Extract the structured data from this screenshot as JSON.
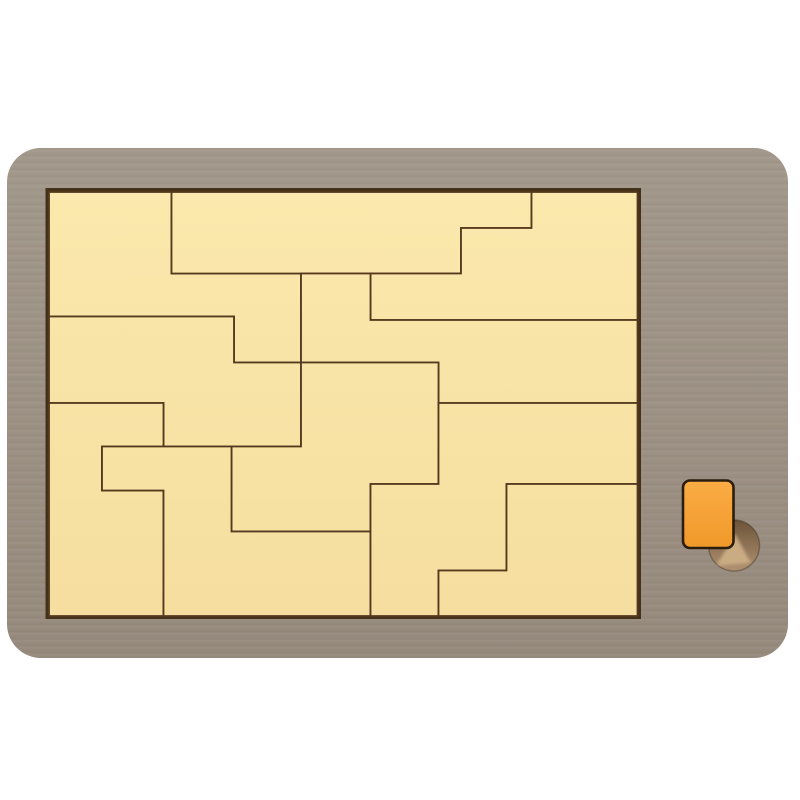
{
  "scene": {
    "width": 800,
    "height": 800
  },
  "colors": {
    "background": "#FFFFFF",
    "frame_top": "#A2988B",
    "frame_bottom": "#968A7D",
    "recess": "#45311A",
    "cream_top": "#FBE8AC",
    "cream_bottom": "#F5DE9F",
    "piece_line": "#54391E",
    "orange_top": "#FAAC45",
    "orange_bottom": "#F0992A",
    "orange_outline": "#2B1D0E",
    "hole_top": "#6B5339",
    "hole_bottom": "#B29272",
    "hole_wedge": "#CDAE85",
    "hole_rim": "rgba(43,28,14,0.35)"
  },
  "board": {
    "x": 7,
    "y": 148,
    "width": 781,
    "height": 510,
    "radius": 34
  },
  "tray_recess": {
    "x": 45.5,
    "y": 188,
    "width": 595.5,
    "height": 431
  },
  "tray": {
    "x": 49,
    "y": 192,
    "width": 588.5,
    "height": 424
  },
  "pieces": [
    {
      "id": "top-left",
      "points": [
        [
          49,
          192
        ],
        [
          171.5,
          192
        ],
        [
          171.5,
          273.5
        ],
        [
          301,
          273.5
        ],
        [
          301,
          362.5
        ],
        [
          234,
          362.5
        ],
        [
          234,
          316.5
        ],
        [
          49,
          316.5
        ]
      ]
    },
    {
      "id": "top-bar",
      "points": [
        [
          171.5,
          192
        ],
        [
          531.5,
          192
        ],
        [
          531.5,
          228
        ],
        [
          461,
          228
        ],
        [
          461,
          273.5
        ],
        [
          171.5,
          273.5
        ]
      ]
    },
    {
      "id": "top-right",
      "points": [
        [
          531.5,
          192
        ],
        [
          637.5,
          192
        ],
        [
          637.5,
          320
        ],
        [
          370.5,
          320
        ],
        [
          370.5,
          273.5
        ],
        [
          461,
          273.5
        ],
        [
          461,
          228
        ],
        [
          531.5,
          228
        ]
      ]
    },
    {
      "id": "upper-middle",
      "points": [
        [
          301,
          273.5
        ],
        [
          370.5,
          273.5
        ],
        [
          370.5,
          320
        ],
        [
          637.5,
          320
        ],
        [
          637.5,
          403
        ],
        [
          438.5,
          403
        ],
        [
          438.5,
          362.5
        ],
        [
          301,
          362.5
        ]
      ]
    },
    {
      "id": "left-middle",
      "points": [
        [
          49,
          316.5
        ],
        [
          234,
          316.5
        ],
        [
          234,
          362.5
        ],
        [
          301,
          362.5
        ],
        [
          301,
          446.5
        ],
        [
          163.5,
          446.5
        ],
        [
          163.5,
          403
        ],
        [
          49,
          403
        ]
      ]
    },
    {
      "id": "center",
      "points": [
        [
          301,
          362.5
        ],
        [
          438.5,
          362.5
        ],
        [
          438.5,
          484
        ],
        [
          370.5,
          484
        ],
        [
          370.5,
          531.5
        ],
        [
          231.5,
          531.5
        ],
        [
          231.5,
          446.5
        ],
        [
          301,
          446.5
        ]
      ]
    },
    {
      "id": "bottom-left",
      "points": [
        [
          49,
          403
        ],
        [
          163.5,
          403
        ],
        [
          163.5,
          446.5
        ],
        [
          102,
          446.5
        ],
        [
          102,
          490.5
        ],
        [
          163.5,
          490.5
        ],
        [
          163.5,
          616
        ],
        [
          49,
          616
        ]
      ]
    },
    {
      "id": "bottom-center",
      "points": [
        [
          102,
          446.5
        ],
        [
          231.5,
          446.5
        ],
        [
          231.5,
          531.5
        ],
        [
          370.5,
          531.5
        ],
        [
          370.5,
          616
        ],
        [
          163.5,
          616
        ],
        [
          163.5,
          490.5
        ],
        [
          102,
          490.5
        ]
      ]
    },
    {
      "id": "right-zigzag",
      "points": [
        [
          438.5,
          403
        ],
        [
          637.5,
          403
        ],
        [
          637.5,
          484
        ],
        [
          506.5,
          484
        ],
        [
          506.5,
          570.5
        ],
        [
          438.5,
          570.5
        ],
        [
          438.5,
          616
        ],
        [
          370.5,
          616
        ],
        [
          370.5,
          484
        ],
        [
          438.5,
          484
        ]
      ]
    },
    {
      "id": "bottom-right",
      "points": [
        [
          506.5,
          484
        ],
        [
          637.5,
          484
        ],
        [
          637.5,
          616
        ],
        [
          438.5,
          616
        ],
        [
          438.5,
          570.5
        ],
        [
          506.5,
          570.5
        ]
      ]
    }
  ],
  "piece_stroke_width": 1.8,
  "orange_piece": {
    "x": 683,
    "y": 480.5,
    "width": 50.5,
    "height": 67.5,
    "radius": 7,
    "outline_width": 2.6
  },
  "finger_hole": {
    "cx": 734,
    "cy": 545.5,
    "r": 25.5,
    "wedge": [
      [
        716,
        566
      ],
      [
        751,
        563
      ],
      [
        735,
        534
      ]
    ]
  }
}
